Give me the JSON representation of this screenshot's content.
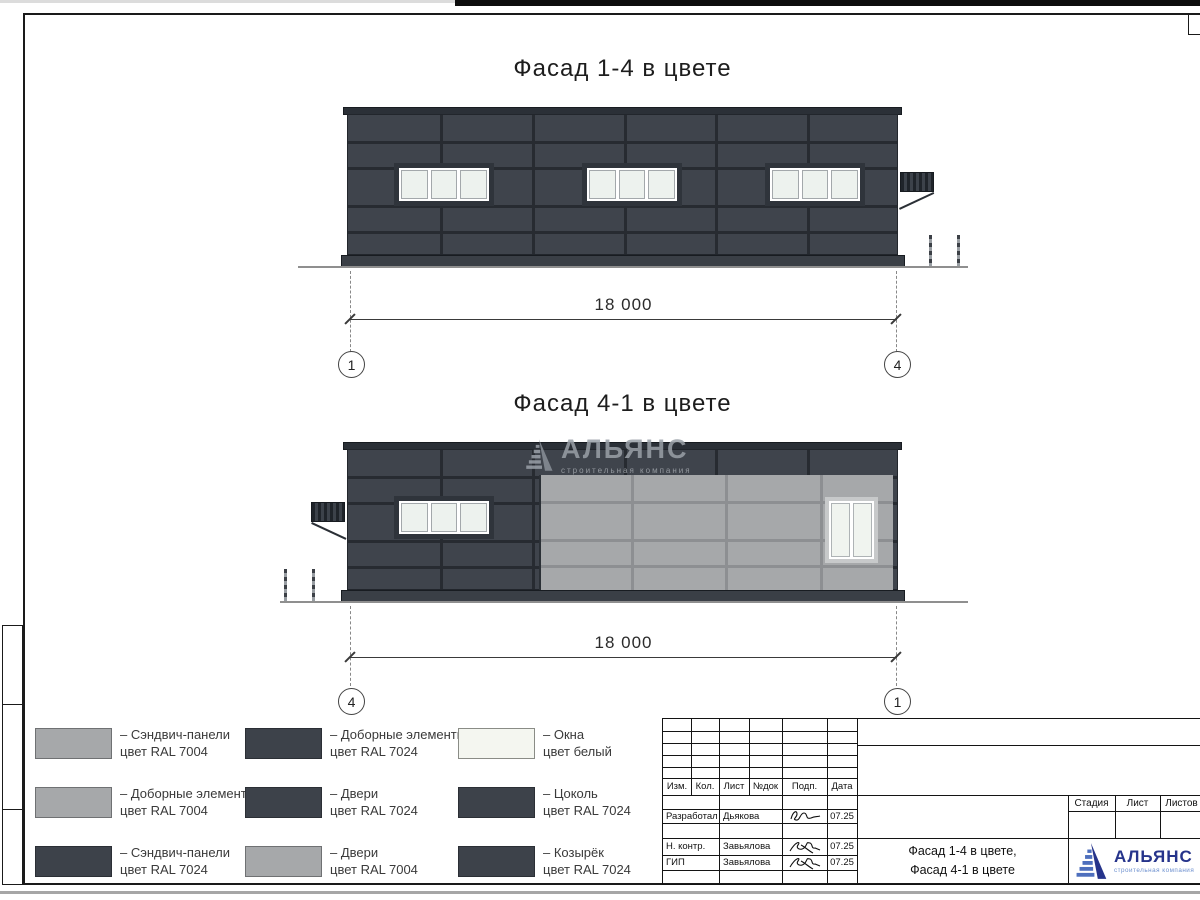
{
  "facade_top": {
    "title": "Фасад 1-4 в цвете",
    "dimension_label": "18 000",
    "axis_left": "1",
    "axis_right": "4"
  },
  "facade_bottom": {
    "title": "Фасад 4-1 в цвете",
    "dimension_label": "18 000",
    "axis_left": "4",
    "axis_right": "1"
  },
  "watermark": {
    "brand": "АЛЬЯНС",
    "tagline": "строительная компания"
  },
  "legend": {
    "items": [
      {
        "swatch": "light",
        "line1": "– Сэндвич-панели",
        "line2": "цвет RAL 7004"
      },
      {
        "swatch": "dark",
        "line1": "– Доборные элементы",
        "line2": "цвет RAL 7024"
      },
      {
        "swatch": "white",
        "line1": "– Окна",
        "line2": "цвет белый"
      },
      {
        "swatch": "light",
        "line1": "– Доборные элементы",
        "line2": "цвет RAL 7004"
      },
      {
        "swatch": "dark",
        "line1": "– Двери",
        "line2": "цвет RAL 7024"
      },
      {
        "swatch": "dark",
        "line1": "– Цоколь",
        "line2": "цвет RAL 7024"
      },
      {
        "swatch": "dark",
        "line1": "– Сэндвич-панели",
        "line2": "цвет RAL 7024"
      },
      {
        "swatch": "light",
        "line1": "– Двери",
        "line2": "цвет RAL 7004"
      },
      {
        "swatch": "dark",
        "line1": "– Козырёк",
        "line2": "цвет RAL 7024"
      }
    ]
  },
  "title_block": {
    "rev_headers": [
      "Изм.",
      "Кол.",
      "Лист",
      "№док",
      "Подп.",
      "Дата"
    ],
    "signers": [
      {
        "role": "Разработал",
        "name": "Дьякова",
        "date": "07.25"
      },
      {
        "role": "Н. контр.",
        "name": "Завьялова",
        "date": "07.25"
      },
      {
        "role": "ГИП",
        "name": "Завьялова",
        "date": "07.25"
      }
    ],
    "stage_headers": [
      "Стадия",
      "Лист",
      "Листов"
    ],
    "doc_title_line1": "Фасад 1-4 в цвете,",
    "doc_title_line2": "Фасад 4-1 в цвете",
    "logo_brand": "АЛЬЯНС",
    "logo_tagline": "строительная компания"
  },
  "colors": {
    "panel_dark_ral7024": "#3f444c",
    "panel_light_ral7004": "#a6a8aa",
    "window_white": "#eef3ee",
    "logo_blue": "#26348b",
    "logo_light_blue": "#6d90cf"
  }
}
